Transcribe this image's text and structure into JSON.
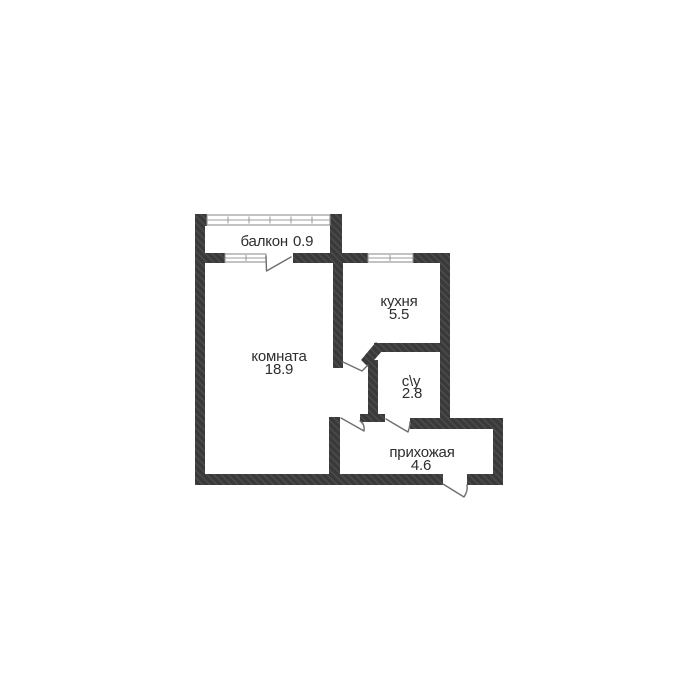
{
  "plan": {
    "type": "apartment-floor-plan",
    "rooms": {
      "balcony": {
        "name": "балкон",
        "area": "0.9"
      },
      "living": {
        "name": "комната",
        "area": "18.9"
      },
      "kitchen": {
        "name": "кухня",
        "area": "5.5"
      },
      "bathroom": {
        "name": "с\\у",
        "area": "2.8"
      },
      "hallway": {
        "name": "прихожая",
        "area": "4.6"
      }
    },
    "colors": {
      "background": "#ffffff",
      "wall": "#3a3a3a",
      "wall_hatch": "#4e4e4e",
      "window_line": "#8f8f8f",
      "door_line": "#6e6e6e",
      "text": "#2d2d2d"
    }
  }
}
